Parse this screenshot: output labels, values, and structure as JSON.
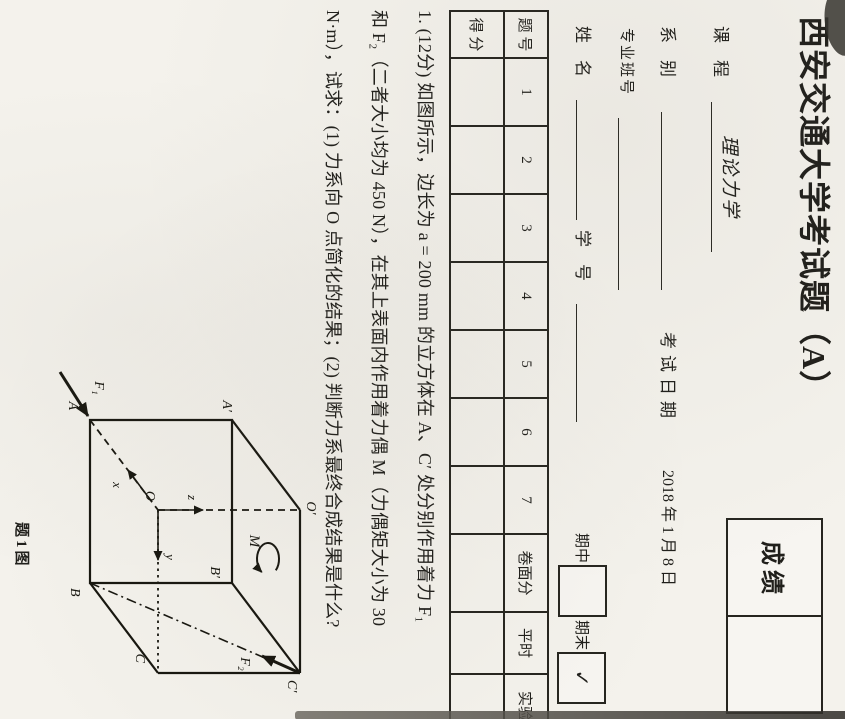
{
  "page": {
    "title": "西安交通大学考试题（A）",
    "grade_box": {
      "label": "成绩"
    },
    "fields": {
      "course_label": "课　程",
      "course_value": "理论力学",
      "dept_label": "系　别",
      "exam_date_label": "考试日期",
      "exam_date_value": "2018 年 1 月 8 日",
      "class_label": "专业班号",
      "name_label": "姓　名",
      "id_label": "学　号",
      "midterm_label": "期中",
      "final_label": "期末",
      "final_checkmark": "✓"
    },
    "score_table": {
      "row1_label": "题 号",
      "row2_label": "得 分",
      "columns": [
        "1",
        "2",
        "3",
        "4",
        "5",
        "6",
        "7",
        "卷面分",
        "平时",
        "实验"
      ]
    },
    "question": {
      "line1": "1. (12分) 如图所示，边长为 a = 200 mm 的立方体在 A、C′ 处分别作用着力 F₁",
      "line2": "和 F₂（二者大小均为 450 N），在其上表面内作用着力偶 M（力偶矩大小为 30",
      "line3": "N·m），试求：(1) 力系向 O 点简化的结果；(2) 判断力系最终合成结果是什么?"
    },
    "figure": {
      "caption": "题1图",
      "labels": {
        "A": "A",
        "A_prime": "A′",
        "B": "B",
        "B_prime": "B′",
        "C": "C",
        "C_prime": "C′",
        "O": "O",
        "O_prime": "O′",
        "x": "x",
        "y": "y",
        "z": "z",
        "F1": "F₁",
        "F2": "F₂",
        "M": "M"
      }
    }
  }
}
